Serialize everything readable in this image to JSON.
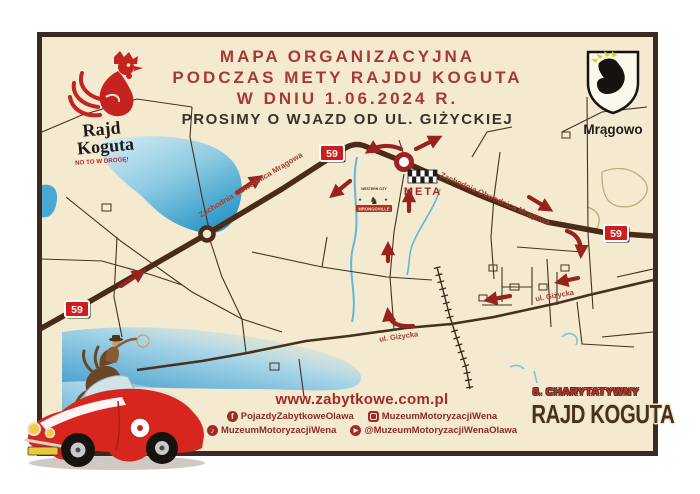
{
  "poster": {
    "title": {
      "line1": "MAPA ORGANIZACYJNA",
      "line2": "PODCZAS METY RAJDU KOGUTA",
      "line3": "W DNIU 1.06.2024 R.",
      "line4": "PROSIMY O WJAZD OD UL. GIŻYCKIEJ"
    },
    "rally_logo": {
      "word1": "Rajd",
      "word2": "Koguta",
      "tagline": "NO TO W DROGĘ!"
    },
    "city_crest": {
      "name": "Mrągowo"
    },
    "map": {
      "route_number": "59",
      "bypass_label_west": "Zachodnia Obwodnica Mrągowa",
      "bypass_label_east": "Zachodnia Obwodnica Mrągowa",
      "street_label_west": "ul. Giżycka",
      "street_label_east": "ul. Giżycka",
      "finish": "META",
      "western_town": {
        "arc_text": "WESTERN CITY",
        "banner": "MRONGOVILLE"
      }
    },
    "footer": {
      "website": "www.zabytkowe.com.pl",
      "social_row1": [
        {
          "network": "facebook",
          "handle": "PojazdyZabytkoweOlawa"
        },
        {
          "network": "instagram",
          "handle": "MuzeumMotoryzacjiWena"
        }
      ],
      "social_row2": [
        {
          "network": "tiktok",
          "handle": "MuzeumMotoryzacjiWena"
        },
        {
          "network": "youtube",
          "handle": "@MuzeumMotoryzacjiWenaOlawa"
        }
      ]
    },
    "event_badge": {
      "line1": "8. CHARYTATYWNY",
      "line2": "RAJD KOGUTA"
    }
  },
  "colors": {
    "cream": "#f3ead0",
    "border_brown": "#3b2922",
    "title_red": "#a63a33",
    "badge_red": "#cf1d1b",
    "arrow_red": "#97231d",
    "road_brown": "#4b2a17",
    "lake_blue": "#2e98c8",
    "logo_red": "#c4231f"
  }
}
